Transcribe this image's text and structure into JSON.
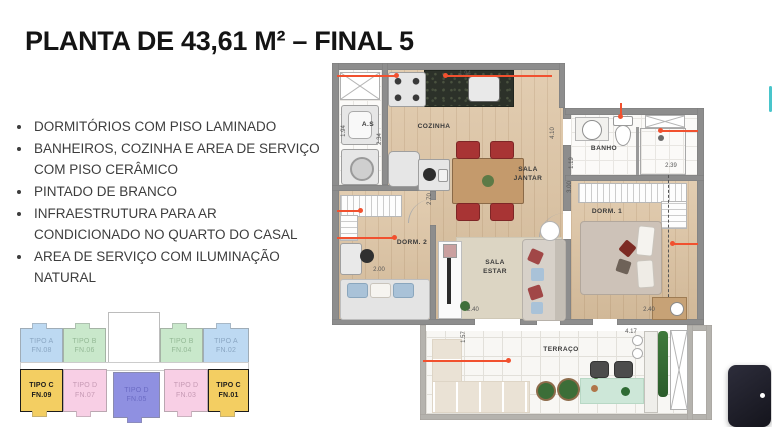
{
  "title": "PLANTA DE 43,61 M² – FINAL 5",
  "features": [
    "DORMITÓRIOS COM PISO LAMINADO",
    "BANHEIROS, COZINHA E AREA DE SERVIÇO COM PISO CERÂMICO",
    "PINTADO DE BRANCO",
    "INFRAESTRUTURA PARA AR CONDICIONADO NO QUARTO DO CASAL",
    "AREA DE SERVIÇO COM ILUMINAÇÃO NATURAL"
  ],
  "keyplan": {
    "units": [
      {
        "type": "TIPO A",
        "fn": "FN.08",
        "color": "#bdd9f2",
        "text_color": "#8aa6c2",
        "highlighted": false
      },
      {
        "type": "TIPO B",
        "fn": "FN.06",
        "color": "#c9e8cb",
        "text_color": "#94b996",
        "highlighted": false
      },
      {
        "type": "TIPO B",
        "fn": "FN.04",
        "color": "#c9e8cb",
        "text_color": "#94b996",
        "highlighted": false
      },
      {
        "type": "TIPO A",
        "fn": "FN.02",
        "color": "#bdd9f2",
        "text_color": "#8aa6c2",
        "highlighted": false
      },
      {
        "type": "TIPO C",
        "fn": "FN.09",
        "color": "#f3ce62",
        "text_color": "#1b1b1b",
        "highlighted": true
      },
      {
        "type": "TIPO D",
        "fn": "FN.07",
        "color": "#f8cfe5",
        "text_color": "#c69ab4",
        "highlighted": false
      },
      {
        "type": "TIPO D",
        "fn": "FN.05",
        "color": "#8f90e1",
        "text_color": "#6b6bc4",
        "highlighted": false
      },
      {
        "type": "TIPO D",
        "fn": "FN.03",
        "color": "#f8cfe5",
        "text_color": "#c69ab4",
        "highlighted": false
      },
      {
        "type": "TIPO C",
        "fn": "FN.01",
        "color": "#f3ce62",
        "text_color": "#1b1b1b",
        "highlighted": true
      }
    ]
  },
  "plan": {
    "accent_color": "#f1512f",
    "colors": {
      "wall": "#8d8d8d",
      "wood_floor": "#dcc2a0",
      "tile_floor": "#fbfaf8",
      "rug": "#dcd5c3",
      "terrace_mat": "#cde7d8"
    },
    "rooms": {
      "as": "A.S",
      "cozinha": "COZINHA",
      "sala_jantar": "SALA\nJANTAR",
      "banho": "BANHO",
      "dorm1": "DORM. 1",
      "dorm2": "DORM. 2",
      "sala_estar": "SALA\nESTAR",
      "terraco": "TERRAÇO"
    },
    "dimensions": [
      "1.94",
      "2.34",
      "1.94",
      "2.70",
      "2.00",
      "2.40",
      "4.10",
      "1.19",
      "2.39",
      "3.00",
      "2.40",
      "4.17",
      "1.57"
    ]
  },
  "scrollbar": {
    "color": "#49c5cb"
  },
  "widget": {
    "bg": "#22222e",
    "indicator_color": "#ffffff"
  }
}
